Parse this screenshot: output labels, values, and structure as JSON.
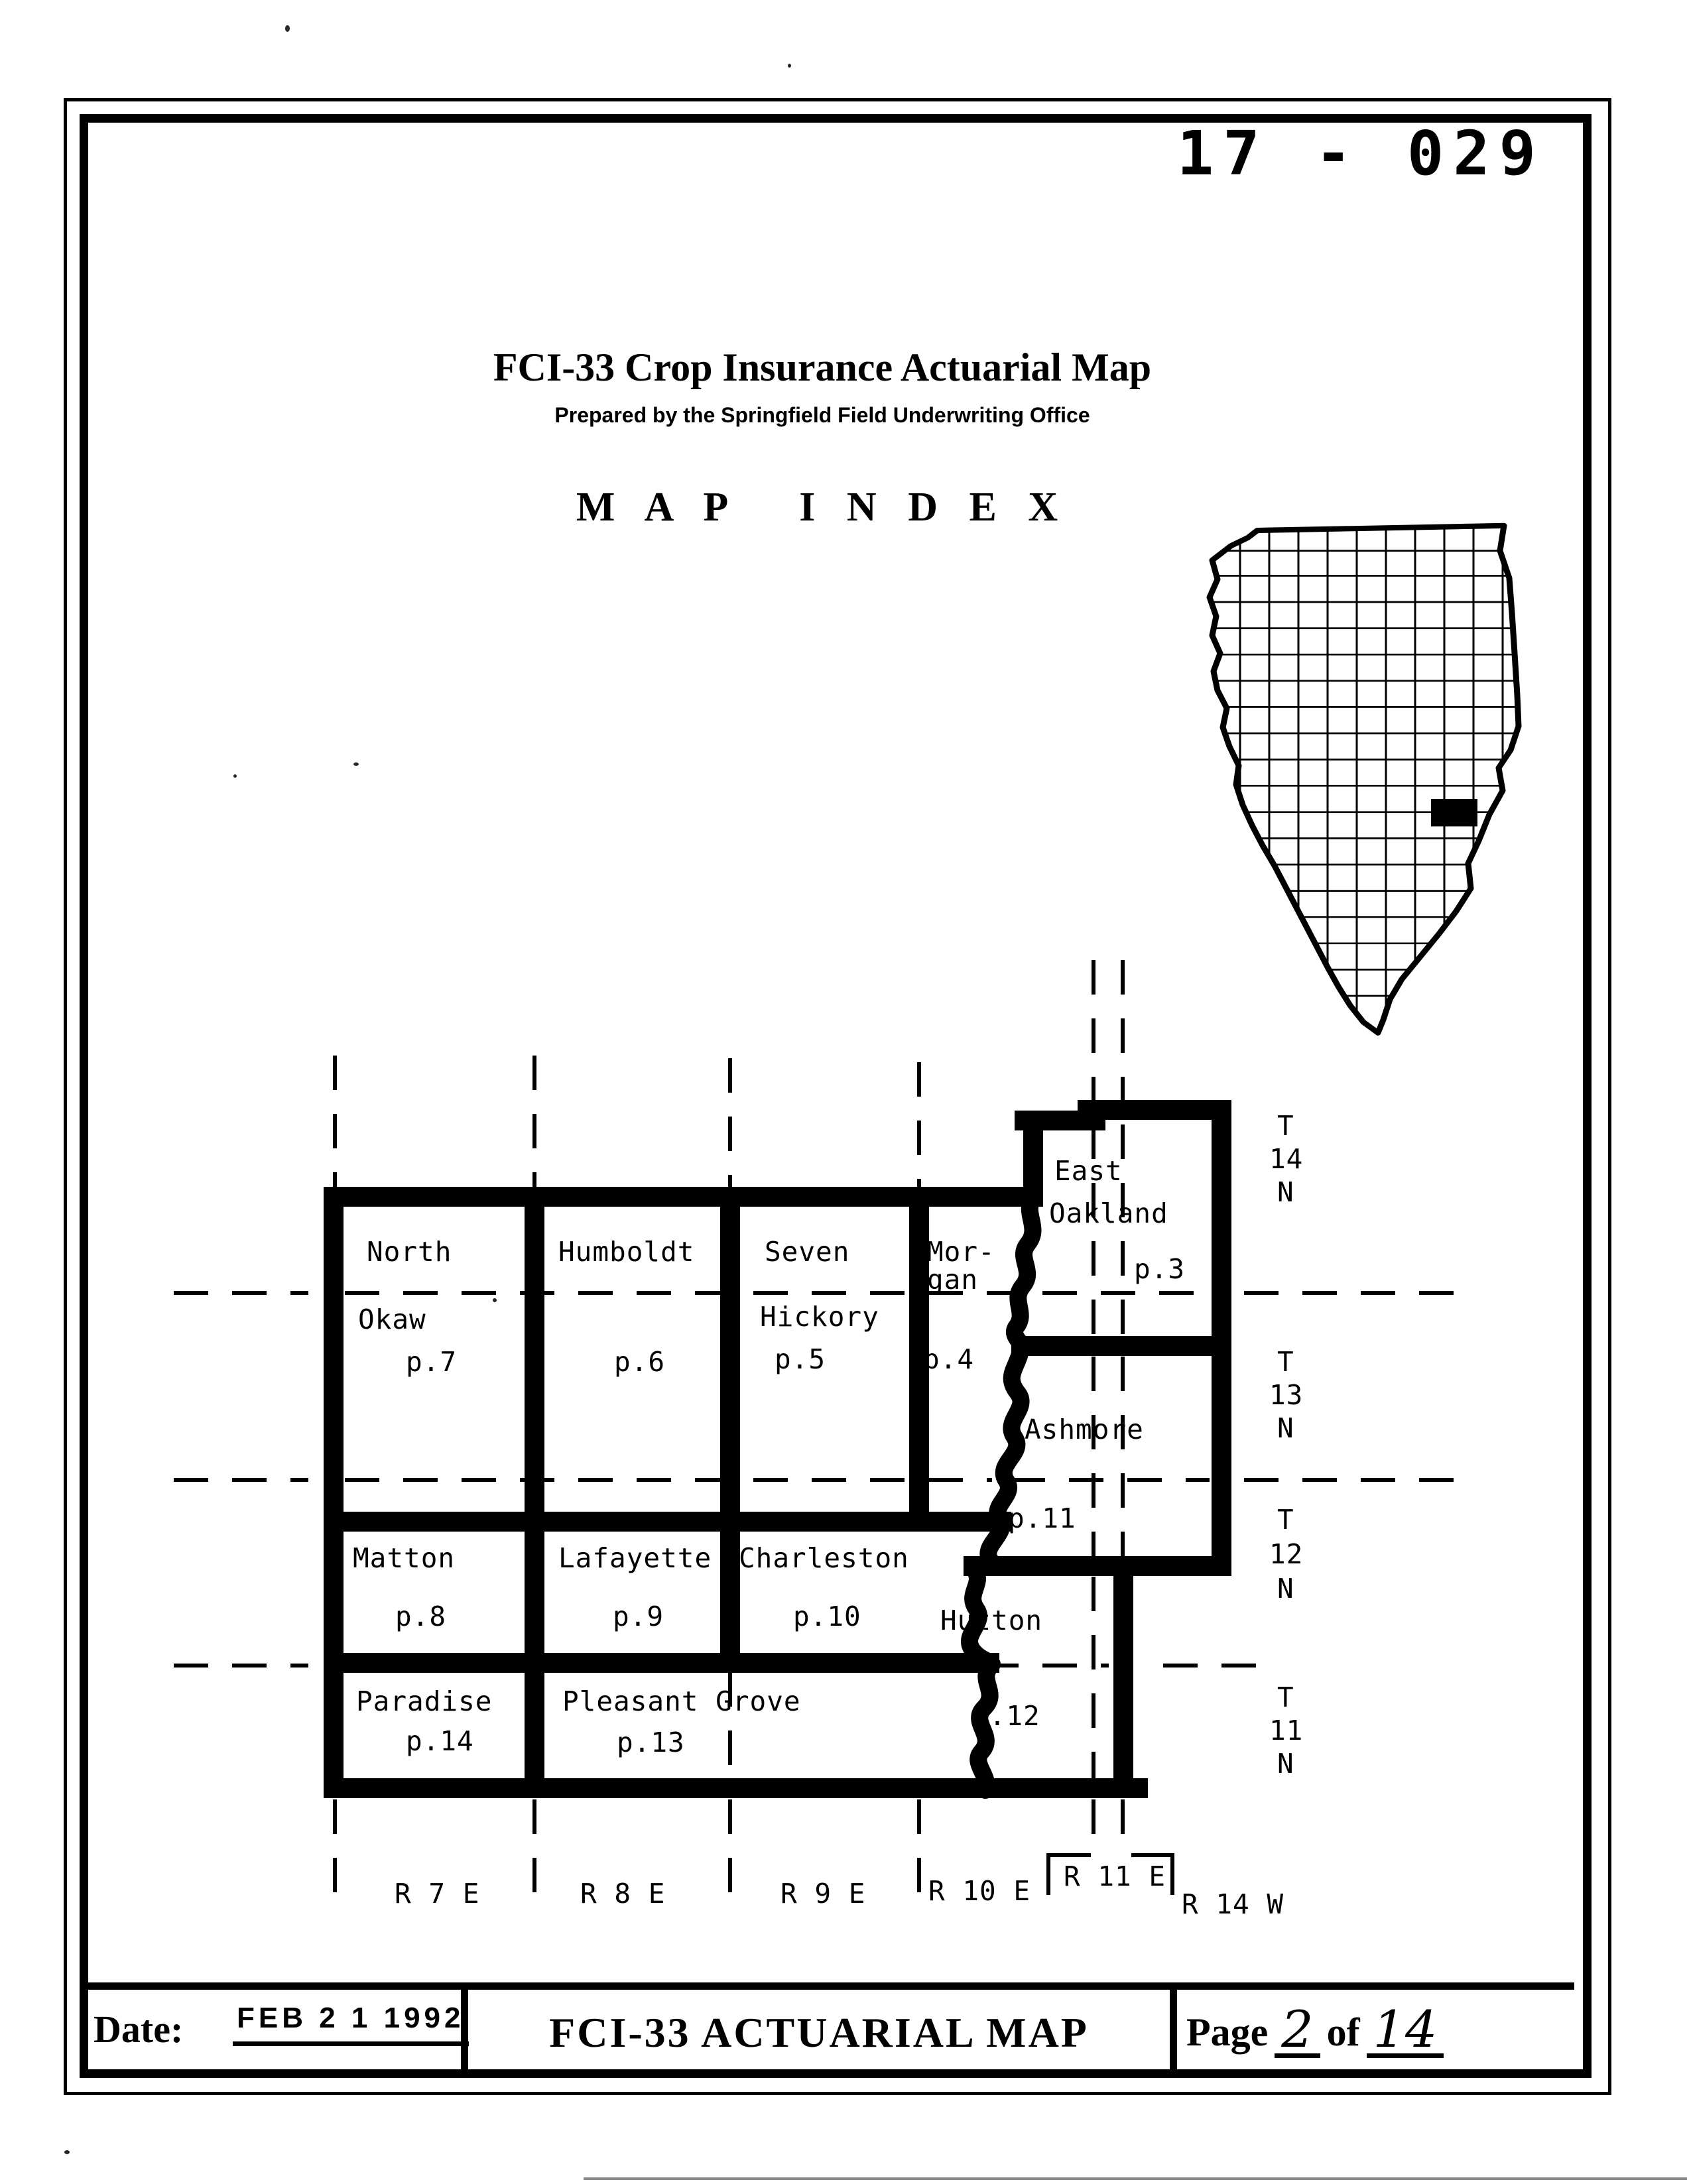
{
  "page": {
    "form_number": "17 - 029",
    "title": "FCI-33 Crop Insurance Actuarial Map",
    "subtitle": "Prepared by the Springfield Field Underwriting Office",
    "heading": "M A P   I N D E X"
  },
  "township_map": {
    "cells": {
      "north_okaw": {
        "line1": "North",
        "line2": "Okaw",
        "page": "p.7"
      },
      "humboldt": {
        "line1": "Humboldt",
        "page": "p.6"
      },
      "seven_hickory": {
        "line1": "Seven",
        "line2": "Hickory",
        "page": "p.5"
      },
      "morgan": {
        "line1": "Mor-",
        "line2": "gan",
        "page": "p.4"
      },
      "east_oakland": {
        "line1": "East",
        "line2": "Oakland",
        "page": "p.3"
      },
      "ashmore": {
        "line1": "Ashmore",
        "page": "p.11"
      },
      "matton": {
        "line1": "Matton",
        "page": "p.8"
      },
      "lafayette": {
        "line1": "Lafayette",
        "page": "p.9"
      },
      "charleston": {
        "line1": "Charleston",
        "page": "p.10"
      },
      "hutton": {
        "line1": "Hutton",
        "page": "p.12"
      },
      "paradise": {
        "line1": "Paradise",
        "page": "p.14"
      },
      "pleasant_grove": {
        "line1": "Pleasant Grove",
        "page": "p.13"
      }
    },
    "township_labels": {
      "t14n": {
        "l1": "T",
        "l2": "14",
        "l3": "N"
      },
      "t13n": {
        "l1": "T",
        "l2": "13",
        "l3": "N"
      },
      "t12n": {
        "l1": "T",
        "l2": "12",
        "l3": "N"
      },
      "t11n": {
        "l1": "T",
        "l2": "11",
        "l3": "N"
      }
    },
    "range_labels": {
      "r7e": "R 7 E",
      "r8e": "R 8 E",
      "r9e": "R 9 E",
      "r10e": "R 10 E",
      "r11e": "R 11 E",
      "r14w": "R 14 W"
    }
  },
  "state_map": {
    "highlighted_county_color": "#000000"
  },
  "footer": {
    "date_label": "Date:",
    "date_stamp": "FEB 2 1 1992",
    "center_title": "FCI-33 ACTUARIAL MAP",
    "page_label": "Page",
    "page_number": "2",
    "of_label": "of",
    "page_total": "14"
  }
}
